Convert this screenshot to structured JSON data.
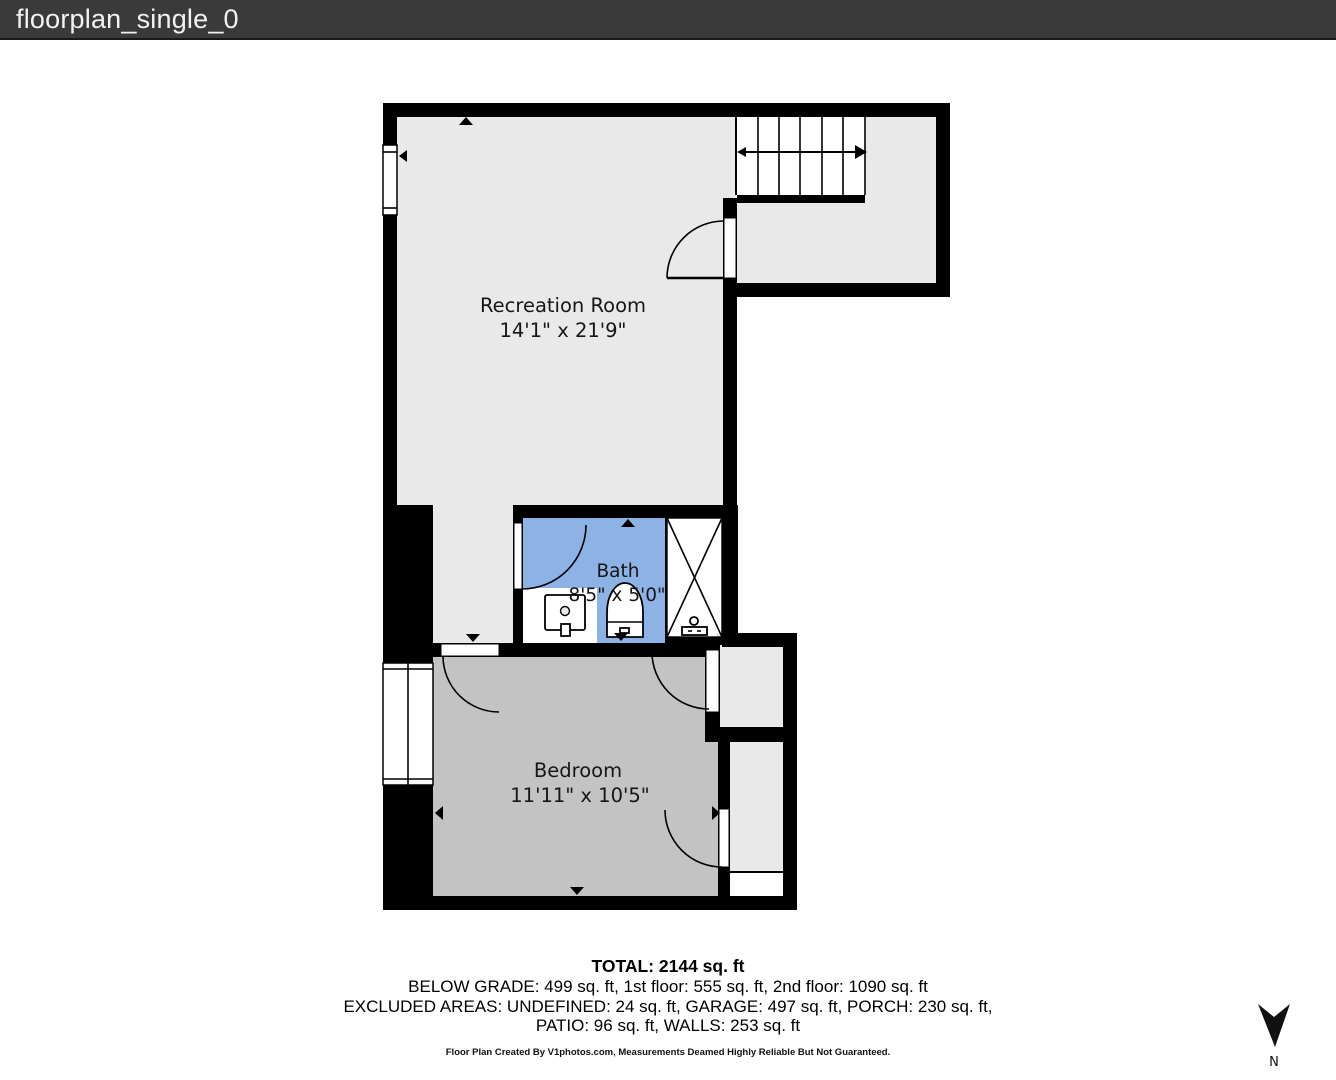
{
  "window": {
    "title": "floorplan_single_0"
  },
  "colors": {
    "titlebar_bg": "#3a3a3a",
    "wall": "#000000",
    "floor_light": "#e9e9e9",
    "floor_bedroom": "#c3c3c3",
    "floor_bath": "#8db3e6",
    "fixture_fill": "#ffffff"
  },
  "rooms": {
    "recreation": {
      "name": "Recreation Room",
      "dims": "14'1\" x 21'9\""
    },
    "bath": {
      "name": "Bath",
      "dims": "8'5\" x 5'0\""
    },
    "bedroom": {
      "name": "Bedroom",
      "dims": "11'11\" x 10'5\""
    }
  },
  "compass": {
    "label": "N"
  },
  "summary": {
    "total": "TOTAL: 2144 sq. ft",
    "floors": "BELOW GRADE: 499 sq. ft, 1st floor: 555 sq. ft, 2nd floor: 1090 sq. ft",
    "excluded_1": "EXCLUDED AREAS: UNDEFINED: 24 sq. ft, GARAGE: 497 sq. ft, PORCH: 230 sq. ft,",
    "excluded_2": "PATIO: 96 sq. ft, WALLS: 253 sq. ft",
    "disclaimer": "Floor Plan Created By V1photos.com, Measurements Deamed Highly Reliable But Not Guaranteed."
  }
}
